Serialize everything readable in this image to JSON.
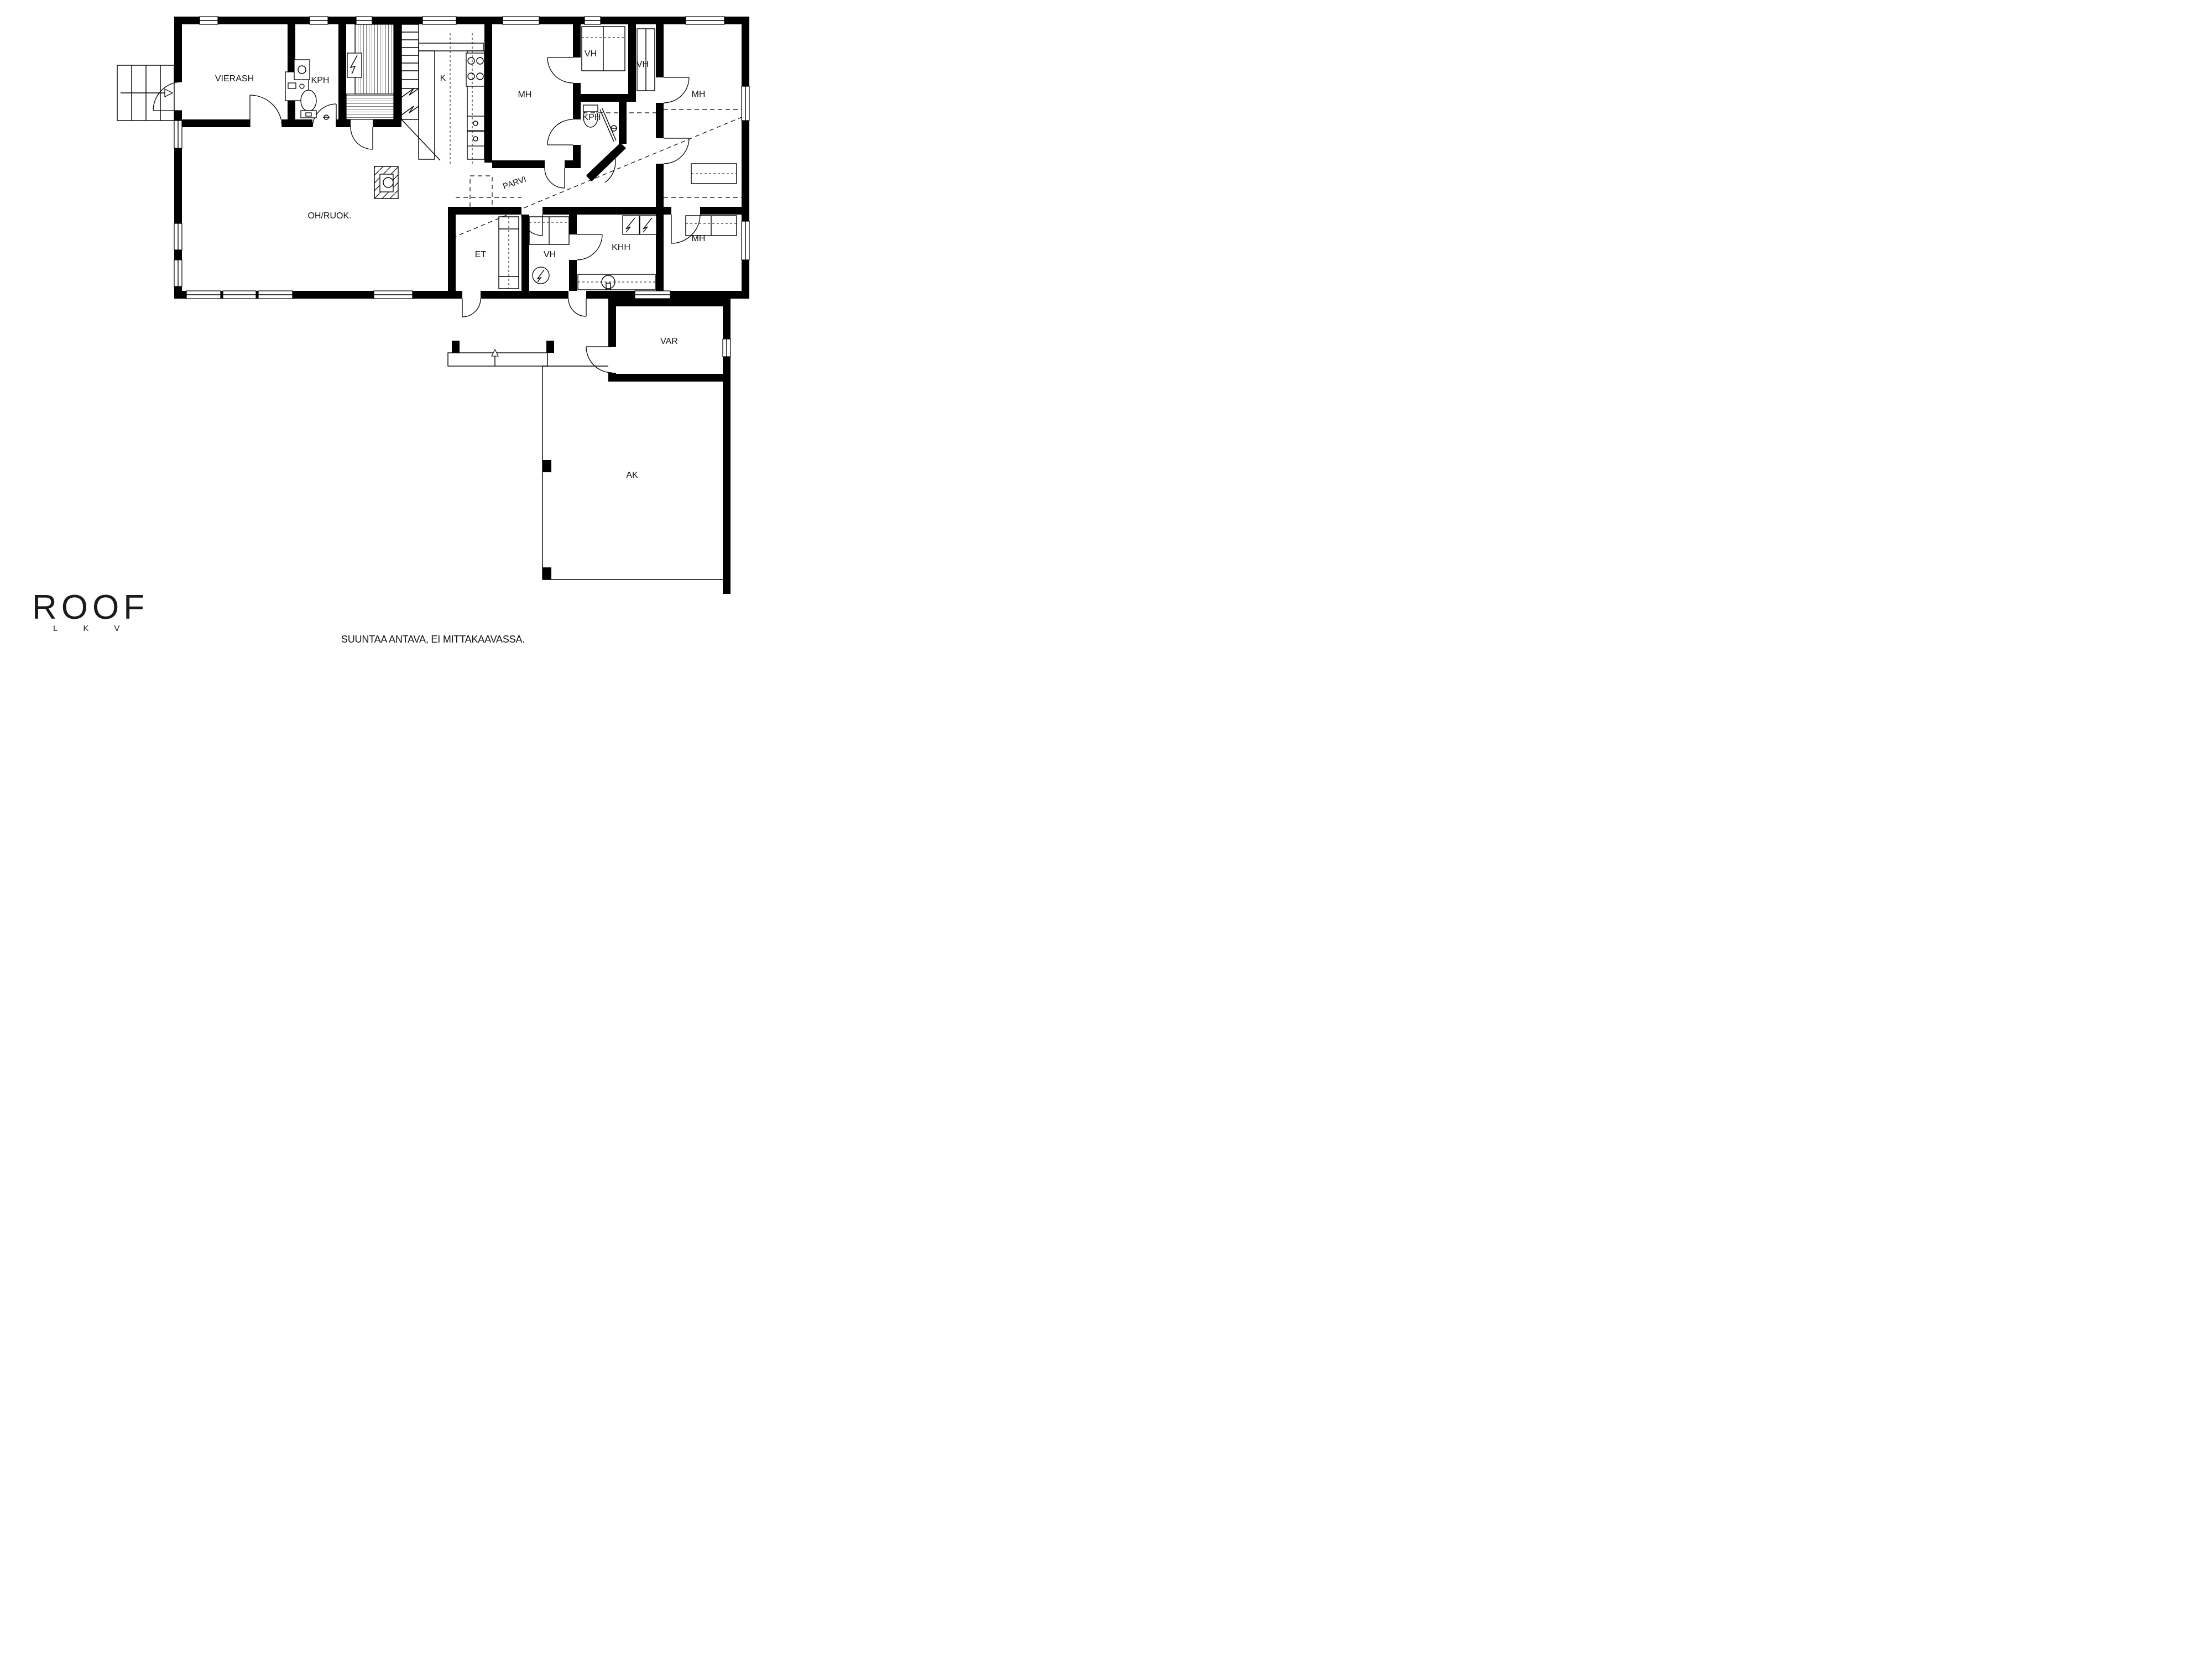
{
  "colors": {
    "wall": "#000000",
    "background": "#ffffff",
    "text": "#111111"
  },
  "plan": {
    "type": "floor-plan",
    "rooms": [
      {
        "id": "vierash",
        "label": "VIERASH"
      },
      {
        "id": "kph-guest",
        "label": "KPH"
      },
      {
        "id": "kitchen",
        "label": "K"
      },
      {
        "id": "mh-mid",
        "label": "MH"
      },
      {
        "id": "vh-top",
        "label": "VH"
      },
      {
        "id": "vh-right",
        "label": "VH"
      },
      {
        "id": "mh-top-right",
        "label": "MH"
      },
      {
        "id": "kph-mid",
        "label": "KPH"
      },
      {
        "id": "parvi",
        "label": "PARVI"
      },
      {
        "id": "oh-ruok",
        "label": "OH/RUOK."
      },
      {
        "id": "et",
        "label": "ET"
      },
      {
        "id": "vh-bottom",
        "label": "VH"
      },
      {
        "id": "khh",
        "label": "KHH"
      },
      {
        "id": "mh-right",
        "label": "MH"
      },
      {
        "id": "var",
        "label": "VAR"
      },
      {
        "id": "ak",
        "label": "AK"
      }
    ]
  },
  "branding": {
    "logo": "ROOF",
    "logo_sub": "LKV"
  },
  "footer": {
    "disclaimer": "SUUNTAA ANTAVA, EI MITTAKAAVASSA."
  }
}
